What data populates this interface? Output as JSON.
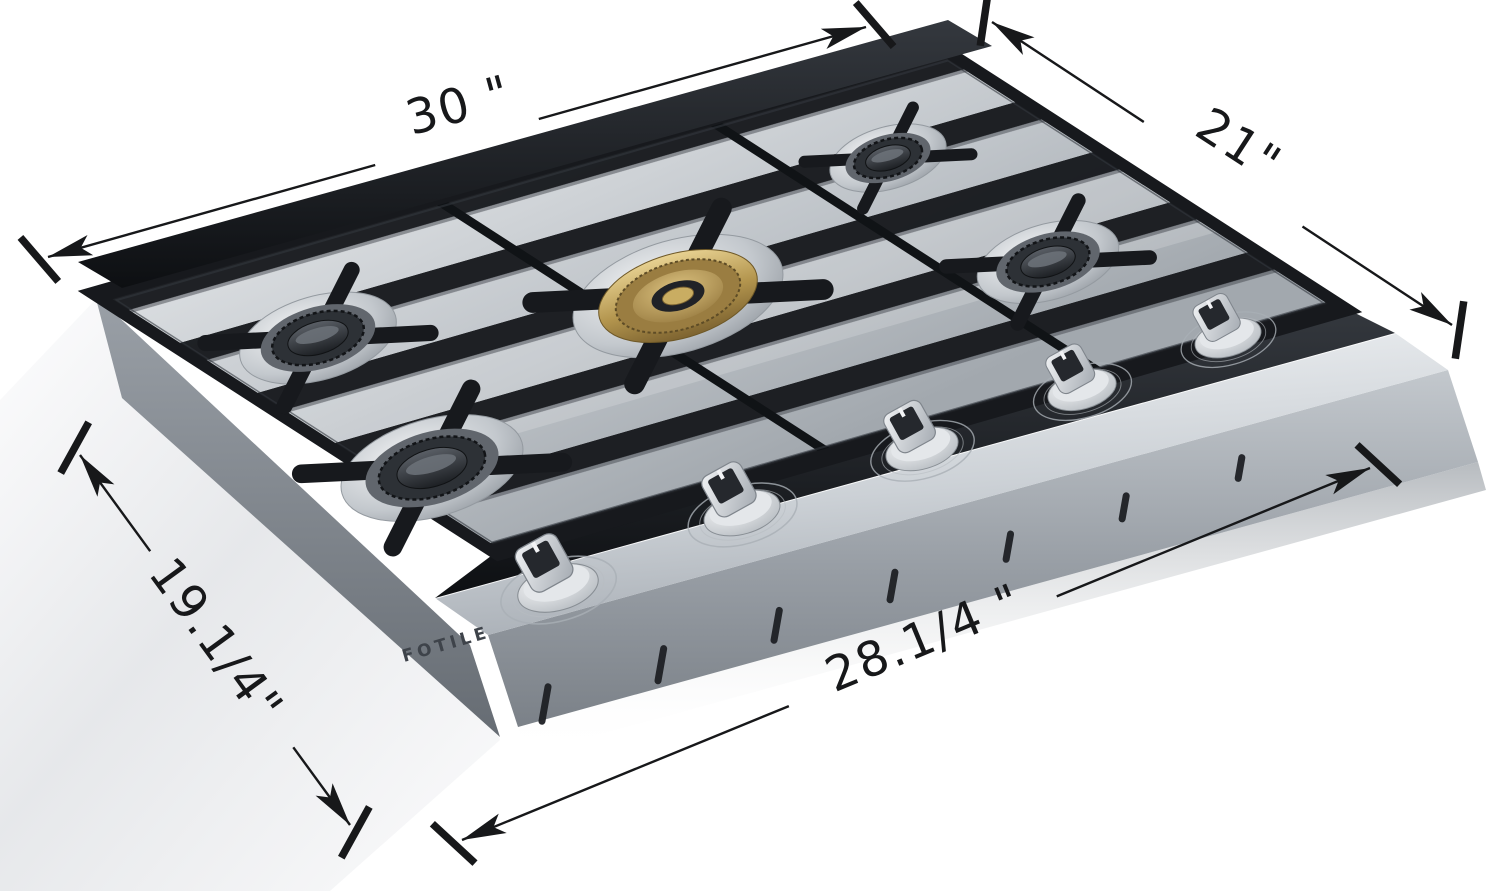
{
  "page": {
    "background": "#ffffff",
    "width_px": 1500,
    "height_px": 891
  },
  "brand": {
    "logo": "FOTILE"
  },
  "product": {
    "kind": "gas cooktop (dimension diagram)",
    "burner_count": 5,
    "knob_count": 5
  },
  "dimensions": [
    {
      "id": "width",
      "label": "30 \"",
      "from": [
        48,
        257
      ],
      "to": [
        866,
        27
      ],
      "gap": [
        0.4,
        0.6
      ],
      "label_pos": [
        463,
        121
      ],
      "label_rot": -15.5
    },
    {
      "id": "depth",
      "label": "21\"",
      "from": [
        992,
        22
      ],
      "to": [
        1452,
        325
      ],
      "gap": [
        0.33,
        0.675
      ],
      "label_pos": [
        1230,
        158
      ],
      "label_rot": 33
    },
    {
      "id": "left-depth",
      "label": "19.1/4\"",
      "from": [
        80,
        455
      ],
      "to": [
        350,
        825
      ],
      "gap": [
        0.26,
        0.79
      ],
      "label_pos": [
        203,
        650
      ],
      "label_rot": 54
    },
    {
      "id": "front-width",
      "label": "28.1/4 \"",
      "from": [
        462,
        840
      ],
      "to": [
        1370,
        468
      ],
      "gap": [
        0.36,
        0.655
      ],
      "label_pos": [
        930,
        653
      ],
      "label_rot": -22.5
    }
  ],
  "cooktop": {
    "burners": [
      {
        "id": "back-left",
        "cx": 318,
        "cy": 338,
        "r": 62,
        "style": "standard"
      },
      {
        "id": "front-left",
        "cx": 432,
        "cy": 468,
        "r": 72,
        "style": "standard"
      },
      {
        "id": "center",
        "cx": 678,
        "cy": 296,
        "r": 80,
        "style": "brass"
      },
      {
        "id": "back-right",
        "cx": 888,
        "cy": 158,
        "r": 46,
        "style": "standard"
      },
      {
        "id": "front-right",
        "cx": 1048,
        "cy": 262,
        "r": 56,
        "style": "standard"
      }
    ],
    "knobs": [
      {
        "cx": 558,
        "cy": 588,
        "s": 1.06
      },
      {
        "cx": 742,
        "cy": 513,
        "s": 1.0
      },
      {
        "cx": 922,
        "cy": 449,
        "s": 0.95
      },
      {
        "cx": 1082,
        "cy": 390,
        "s": 0.9
      },
      {
        "cx": 1228,
        "cy": 338,
        "s": 0.87
      }
    ],
    "vent_slots": {
      "count": 7,
      "from": [
        545,
        704
      ],
      "to": [
        1240,
        468
      ],
      "tilt": 10
    }
  },
  "colors": {
    "dimension_ink": "#17181a",
    "grate_black": "#17191d",
    "stainless_light": "#eef0f3",
    "stainless_mid": "#b5bac0",
    "stainless_dark": "#7e848b",
    "brass": "#c2a356",
    "logo_ink": "#3e434a"
  }
}
